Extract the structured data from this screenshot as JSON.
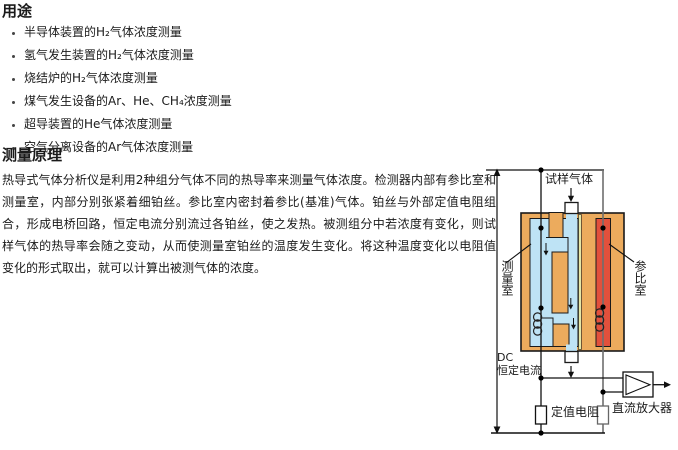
{
  "doc": {
    "applications": {
      "heading": "用途",
      "items": [
        "半导体装置的H₂气体浓度测量",
        "氢气发生装置的H₂气体浓度测量",
        "烧结炉的H₂气体浓度测量",
        "煤气发生设备的Ar、He、CH₄浓度测量",
        "超导装置的He气体浓度测量",
        "空气分离设备的Ar气体浓度测量"
      ]
    },
    "principle": {
      "heading": "测量原理",
      "lines": [
        "热导式气体分析仪是利用2种组分气体不同的热导率来测量气体浓度。检测器内部有参比室和",
        "测量室，内部分别张紧着细铂丝。参比室内密封着参比(基准)气体。铂丝与外部定值电阻组",
        "合，形成电桥回路，恒定电流分别流过各铂丝，使之发热。被测组分中若浓度有变化，则试",
        "样气体的热导率会随之变动，从而使测量室铂丝的温度发生变化。将这种温度变化以电阻值",
        "变化的形式取出，就可以计算出被测气体的浓度。"
      ]
    },
    "diagram": {
      "labels": {
        "sample_gas": "试样气体",
        "measuring_chamber": "测量室",
        "reference_chamber": "参比室",
        "dc_line1": "DC",
        "dc_line2": "恒定电流",
        "fixed_resistor": "定值电阻",
        "dc_amplifier": "直流放大器"
      },
      "colors": {
        "block_body": "#ECAB5D",
        "measuring_channel": "#BEE3F5",
        "reference_channel": "#E2503C",
        "seal_strip": "#E6E6A6",
        "wire_gray": "#6E6E6E"
      }
    }
  }
}
